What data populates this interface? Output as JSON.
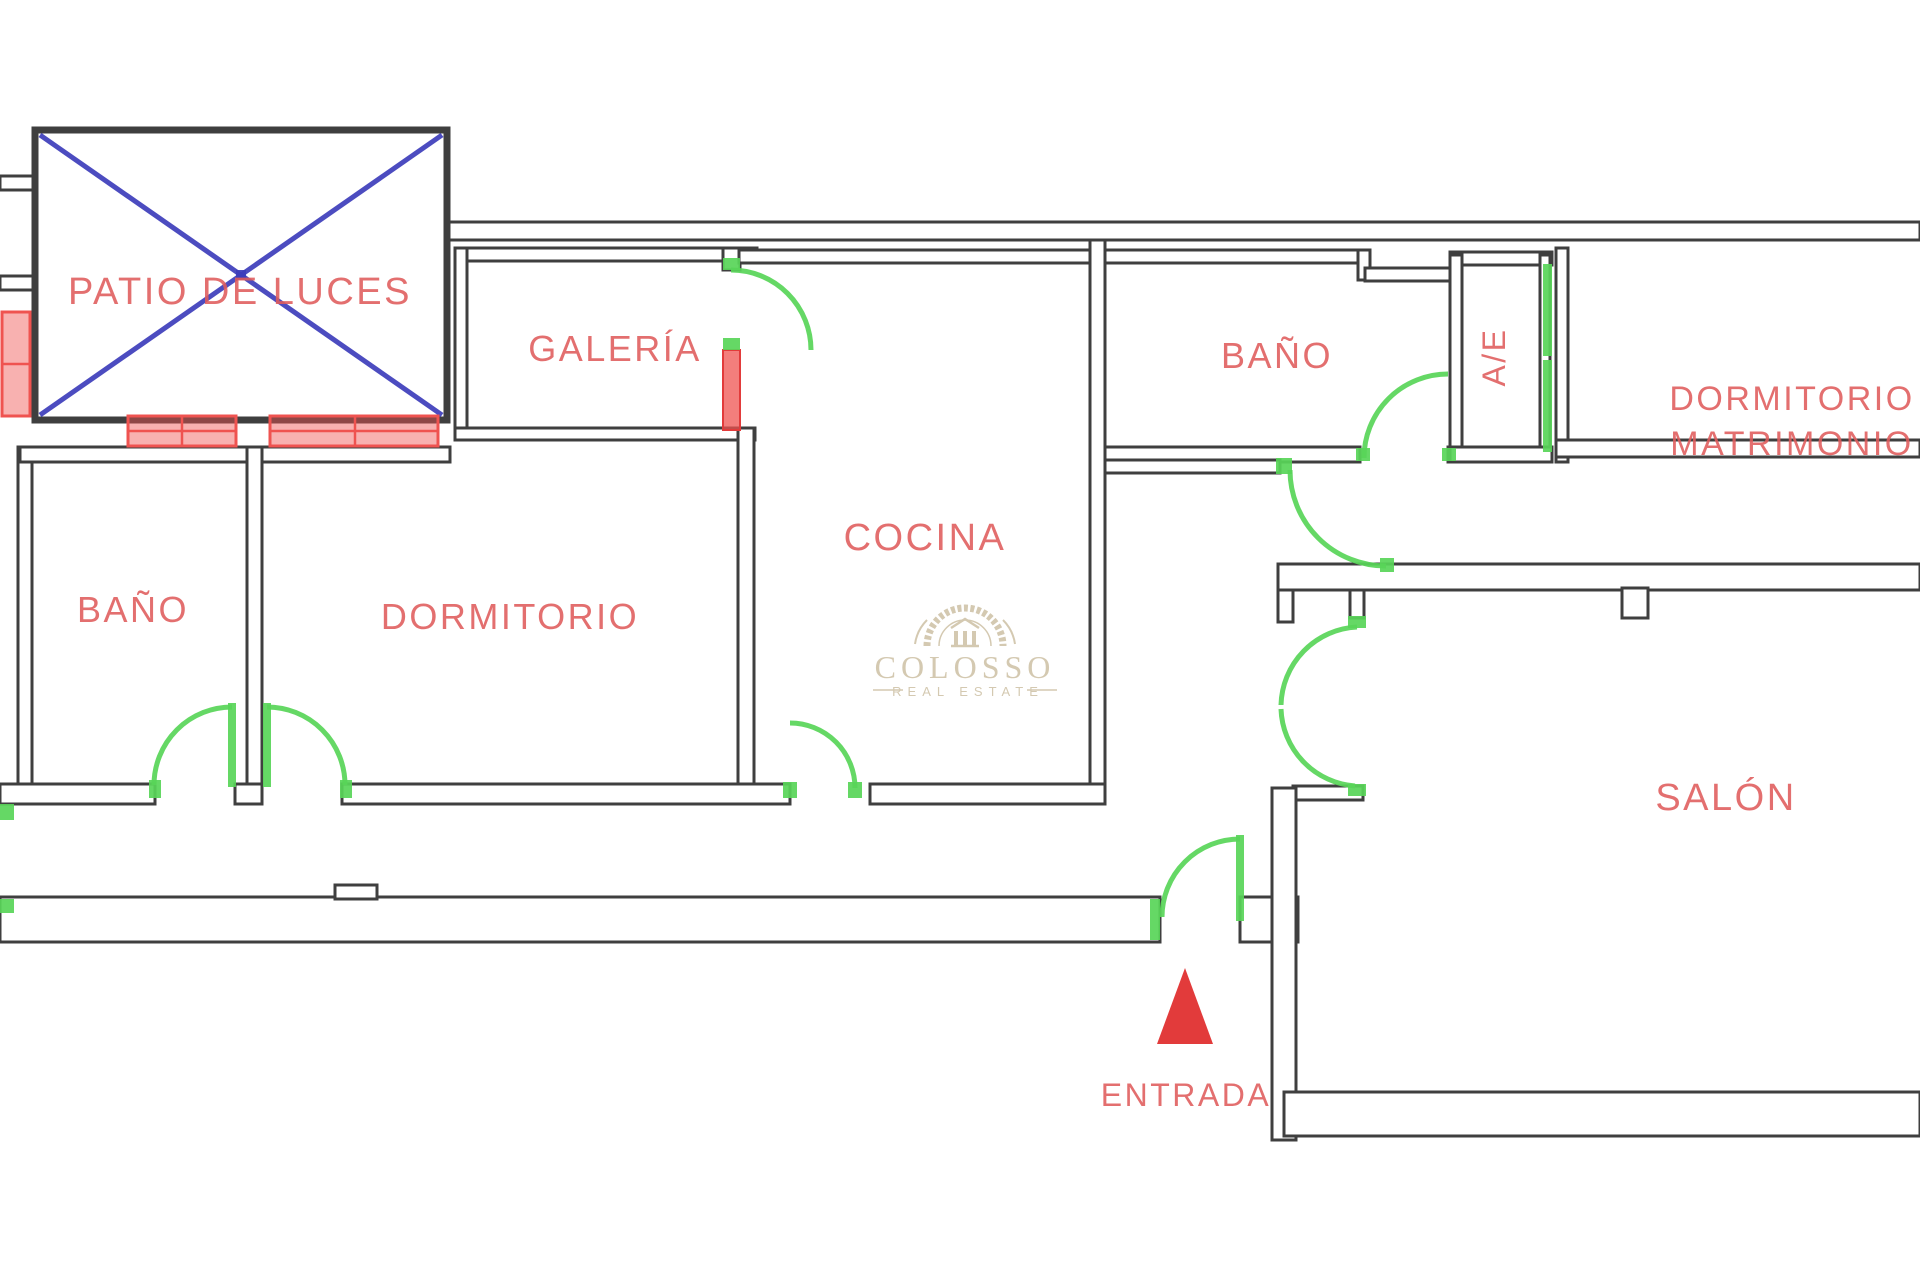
{
  "colors": {
    "wall": "#3f3f3f",
    "label_red": "#e05c5c",
    "accent_red": "#e23b3b",
    "window_red": "#ef5350",
    "door_green": "#58d558",
    "cross_blue": "#3d3dbb",
    "watermark": "#cdc0a4"
  },
  "rooms": {
    "patio": "PATIO DE LUCES",
    "galeria": "GALERÍA",
    "cocina": "COCINA",
    "bano_top": "BAÑO",
    "ae": "A/E",
    "dorm_mat_line1": "DORMITORIO",
    "dorm_mat_line2": "MATRIMONIO",
    "bano_left": "BAÑO",
    "dormitorio": "DORMITORIO",
    "salon": "SALÓN"
  },
  "entrance": {
    "label": "ENTRADA"
  },
  "watermark": {
    "name": "COLOSSO",
    "tagline": "REAL ESTATE"
  }
}
